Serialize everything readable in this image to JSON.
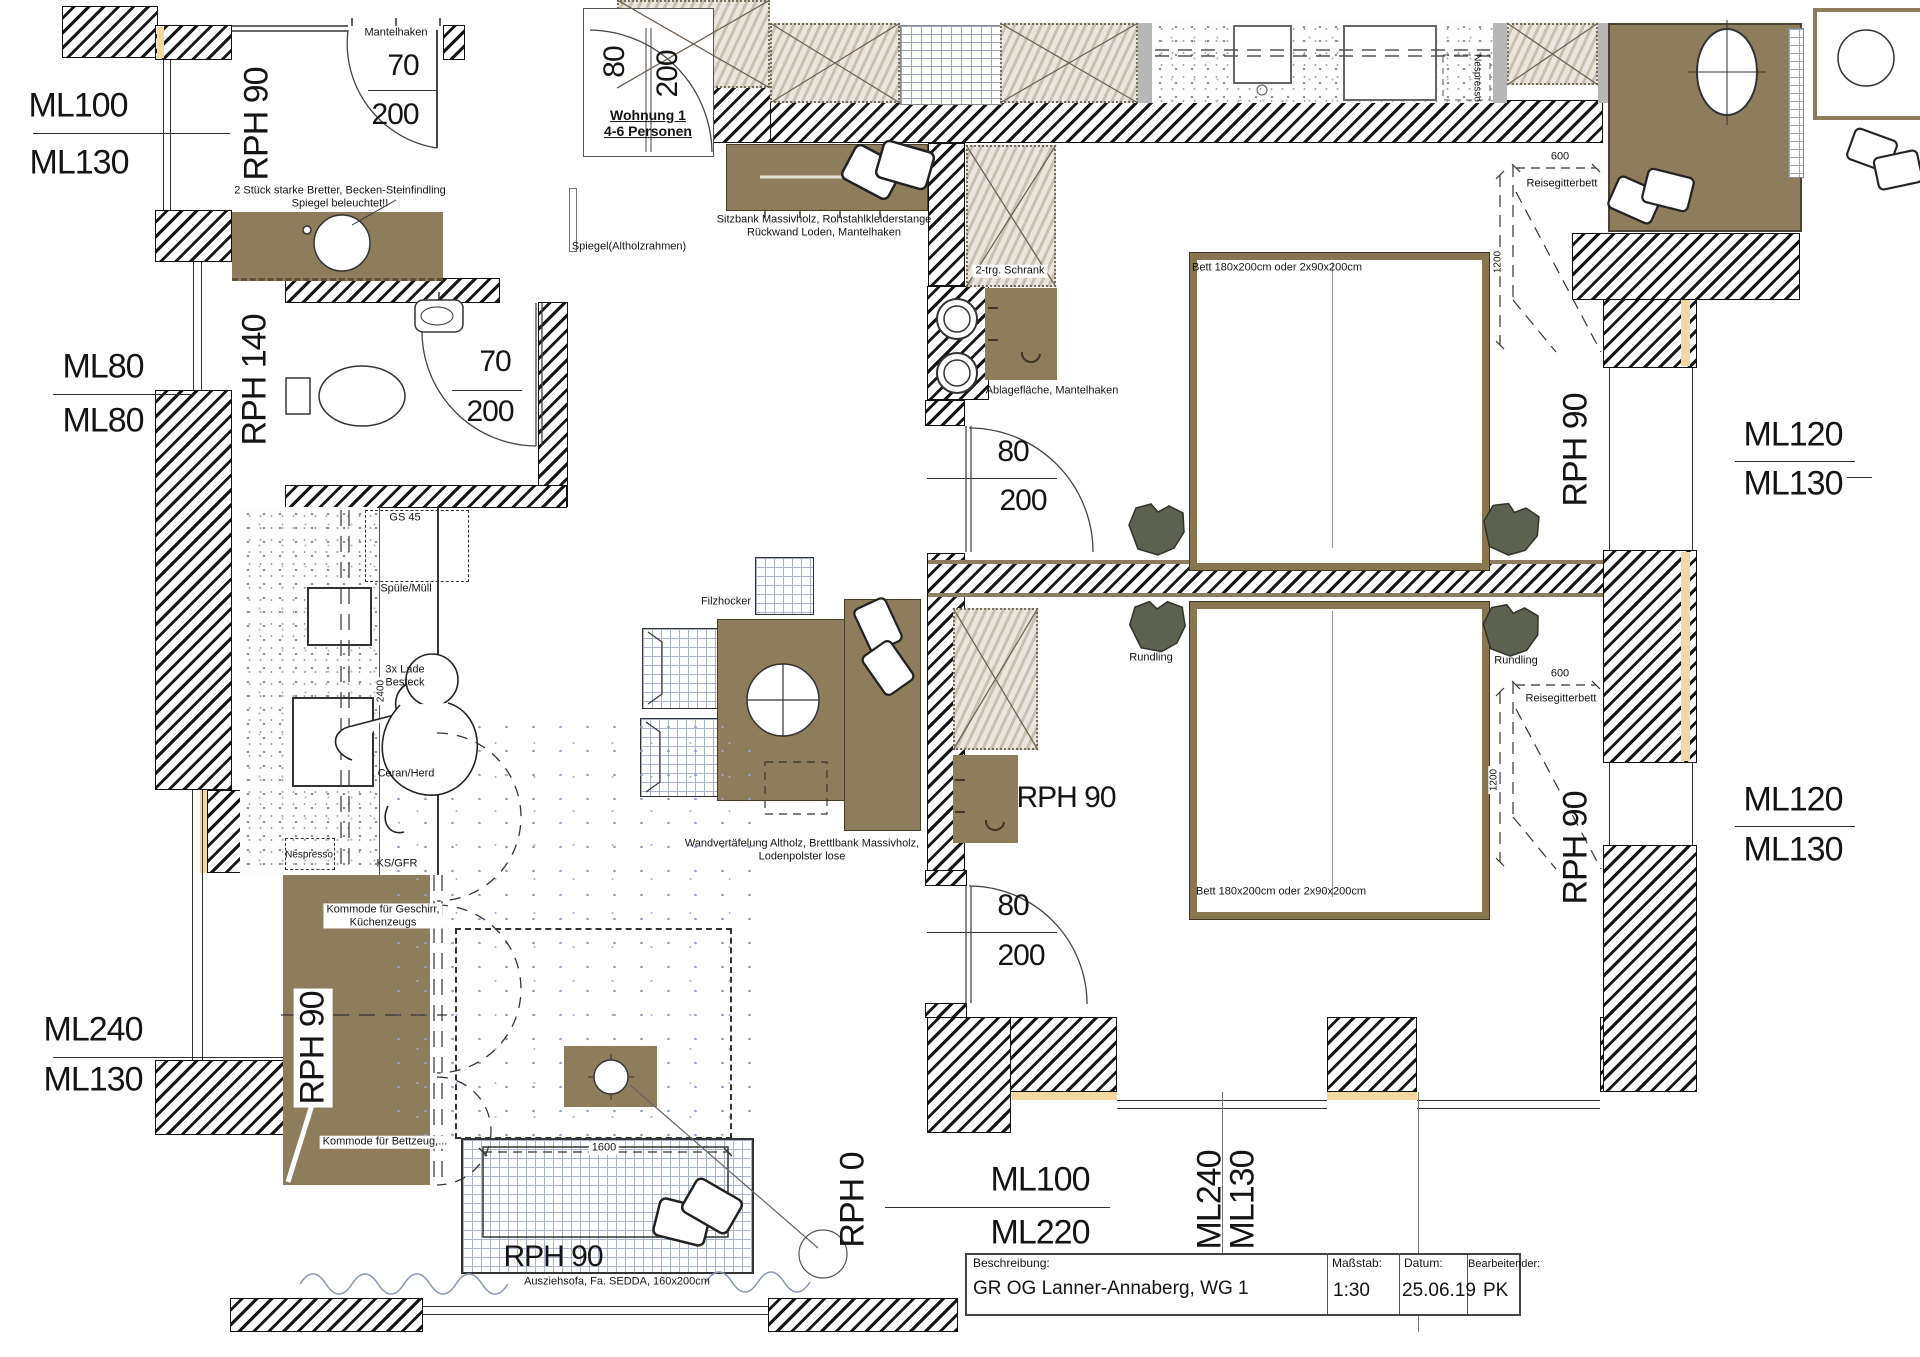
{
  "drawing": {
    "type": "floor-plan",
    "apartment": "Wohnung 1",
    "occupancy": "4-6 Personen"
  },
  "title_block": {
    "description_label": "Beschreibung:",
    "description": "GR OG Lanner-Annaberg, WG 1",
    "scale_label": "Maßstab:",
    "scale": "1:30",
    "date_label": "Datum:",
    "date": "25.06.19",
    "editor_label": "Bearbeitender:",
    "editor": "PK"
  },
  "palette": {
    "wood_brown": "#8e7d5d",
    "bed_frame": "#87764f",
    "wardrobe_beige": "#d9d2c5",
    "insulation_yellow": "#f3d99f",
    "stool_olive": "#5c6151",
    "grid_blue": "#a9b4cc",
    "curtain_blue": "#8a96bb",
    "line_dark": "#141414"
  },
  "label_groups": {
    "outer_dims": [
      {
        "id": "ml100-left",
        "t": "ML100",
        "x": 78,
        "y": 106,
        "fs": 34
      },
      {
        "id": "ml130-left",
        "t": "ML130",
        "x": 79,
        "y": 163,
        "fs": 34
      },
      {
        "id": "ml80-left-a",
        "t": "ML80",
        "x": 103,
        "y": 367,
        "fs": 34
      },
      {
        "id": "ml80-left-b",
        "t": "ML80",
        "x": 103,
        "y": 421,
        "fs": 34
      },
      {
        "id": "ml240-left",
        "t": "ML240",
        "x": 93,
        "y": 1030,
        "fs": 34
      },
      {
        "id": "ml130-left-b",
        "t": "ML130",
        "x": 93,
        "y": 1080,
        "fs": 34
      },
      {
        "id": "ml120-right-a",
        "t": "ML120",
        "x": 1793,
        "y": 435,
        "fs": 34
      },
      {
        "id": "ml130-right-a",
        "t": "ML130",
        "x": 1793,
        "y": 484,
        "fs": 34
      },
      {
        "id": "ml120-right-b",
        "t": "ML120",
        "x": 1793,
        "y": 800,
        "fs": 34
      },
      {
        "id": "ml130-right-b",
        "t": "ML130",
        "x": 1793,
        "y": 850,
        "fs": 34
      },
      {
        "id": "ml100-bottom",
        "t": "ML100",
        "x": 1040,
        "y": 1180,
        "fs": 34
      },
      {
        "id": "ml220-bottom",
        "t": "ML220",
        "x": 1040,
        "y": 1233,
        "fs": 34
      },
      {
        "id": "ml240-bottom",
        "t": "ML240",
        "x": 1210,
        "y": 1200,
        "fs": 34,
        "r": -90
      },
      {
        "id": "ml130-bottom",
        "t": "ML130",
        "x": 1243,
        "y": 1200,
        "fs": 34,
        "r": -90
      }
    ],
    "room_heights": [
      {
        "id": "rph90-corridor",
        "t": "RPH 90",
        "x": 257,
        "y": 124,
        "fs": 34,
        "r": -90
      },
      {
        "id": "rph140-bath",
        "t": "RPH 140",
        "x": 255,
        "y": 380,
        "fs": 34,
        "r": -90
      },
      {
        "id": "rph90-kommode",
        "t": "RPH 90",
        "x": 313,
        "y": 1048,
        "fs": 34,
        "r": -90,
        "bg": true
      },
      {
        "id": "rph90-sofa",
        "t": "RPH 90",
        "x": 553,
        "y": 1257,
        "fs": 30
      },
      {
        "id": "rph0-living",
        "t": "RPH 0",
        "x": 853,
        "y": 1200,
        "fs": 34,
        "r": -90
      },
      {
        "id": "rph90-bed1",
        "t": "RPH 90",
        "x": 1576,
        "y": 450,
        "fs": 34,
        "r": -90
      },
      {
        "id": "rph90-bed2",
        "t": "RPH 90",
        "x": 1576,
        "y": 848,
        "fs": 34,
        "r": -90
      },
      {
        "id": "rph90-bed2-big",
        "t": "RPH 90",
        "x": 1066,
        "y": 798,
        "fs": 30
      }
    ],
    "doors": [
      {
        "id": "door70-top-w",
        "t": "70",
        "x": 403,
        "y": 66,
        "fs": 30
      },
      {
        "id": "door70-top-h",
        "t": "200",
        "x": 395,
        "y": 115,
        "fs": 30
      },
      {
        "id": "door80-entry-w",
        "t": "80",
        "x": 615,
        "y": 62,
        "fs": 30,
        "r": -90
      },
      {
        "id": "door80-entry-h",
        "t": "200",
        "x": 668,
        "y": 74,
        "fs": 30,
        "r": -90
      },
      {
        "id": "wohnung-tag",
        "t": "Wohnung 1\n4-6 Personen",
        "x": 648,
        "y": 124,
        "fs": 14,
        "b": true,
        "u": true
      },
      {
        "id": "door70-bath-w",
        "t": "70",
        "x": 495,
        "y": 362,
        "fs": 30
      },
      {
        "id": "door70-bath-h",
        "t": "200",
        "x": 490,
        "y": 412,
        "fs": 30
      },
      {
        "id": "door80-bed1-w",
        "t": "80",
        "x": 1013,
        "y": 452,
        "fs": 30
      },
      {
        "id": "door80-bed1-h",
        "t": "200",
        "x": 1023,
        "y": 501,
        "fs": 30
      },
      {
        "id": "door80-bed2-w",
        "t": "80",
        "x": 1013,
        "y": 906,
        "fs": 30
      },
      {
        "id": "door80-bed2-h",
        "t": "200",
        "x": 1021,
        "y": 956,
        "fs": 30
      }
    ],
    "annotations": [
      {
        "id": "note-mantelhaken",
        "t": "Mantelhaken",
        "x": 396,
        "y": 33,
        "fs": 11
      },
      {
        "id": "note-bretter",
        "t": "2 Stück starke Bretter, Becken-Steinfindling\nSpiegel beleuchtet!!",
        "x": 340,
        "y": 197,
        "fs": 11
      },
      {
        "id": "note-spiegel",
        "t": "Spiegel(Altholzrahmen)",
        "x": 629,
        "y": 247,
        "fs": 11
      },
      {
        "id": "note-sitzbank",
        "t": "Sitzbank Massivholz, Rohstahlkleiderstange\nRückwand Loden, Mantelhaken",
        "x": 824,
        "y": 226,
        "fs": 11
      },
      {
        "id": "note-schrank1",
        "t": "2-trg. Schrank",
        "x": 1010,
        "y": 271,
        "fs": 11,
        "bg": true
      },
      {
        "id": "note-ablage1",
        "t": "Ablagefläche, Mantelhaken",
        "x": 1052,
        "y": 391,
        "fs": 11
      },
      {
        "id": "note-bett1",
        "t": "Bett 180x200cm oder 2x90x200cm",
        "x": 1277,
        "y": 268,
        "fs": 11
      },
      {
        "id": "note-bett2",
        "t": "Bett 180x200cm oder 2x90x200cm",
        "x": 1281,
        "y": 892,
        "fs": 11
      },
      {
        "id": "note-reisegitterbett1",
        "t": "Reisegitterbett",
        "x": 1562,
        "y": 184,
        "fs": 11
      },
      {
        "id": "note-reisegitterbett2",
        "t": "Reisegitterbett",
        "x": 1561,
        "y": 699,
        "fs": 11
      },
      {
        "id": "note-rundling1",
        "t": "Rundling",
        "x": 1151,
        "y": 658,
        "fs": 11
      },
      {
        "id": "note-rundling2",
        "t": "Rundling",
        "x": 1516,
        "y": 661,
        "fs": 11
      },
      {
        "id": "note-filzhocker",
        "t": "Filzhocker",
        "x": 726,
        "y": 602,
        "fs": 11
      },
      {
        "id": "note-wandvertaefelung",
        "t": "Wandvertäfelung Altholz, Brettlbank Massivholz,\nLodenpolster lose",
        "x": 802,
        "y": 850,
        "fs": 11
      },
      {
        "id": "note-gs45",
        "t": "GS 45",
        "x": 405,
        "y": 518,
        "fs": 11
      },
      {
        "id": "note-spuele",
        "t": "Spüle/Müll",
        "x": 406,
        "y": 589,
        "fs": 11
      },
      {
        "id": "note-lade",
        "t": "3x Lade\nBesteck",
        "x": 405,
        "y": 676,
        "fs": 11
      },
      {
        "id": "note-ceran",
        "t": "Ceran/Herd",
        "x": 406,
        "y": 774,
        "fs": 11
      },
      {
        "id": "note-nespresso",
        "t": "Nespresso",
        "x": 309,
        "y": 855,
        "fs": 10
      },
      {
        "id": "note-ksgfr",
        "t": "KS/GFR",
        "x": 397,
        "y": 864,
        "fs": 11
      },
      {
        "id": "note-kommode1",
        "t": "Kommode für Geschirr,\nKüchenzeugs",
        "x": 383,
        "y": 916,
        "fs": 11,
        "bg": true
      },
      {
        "id": "note-kommode2",
        "t": "Kommode für Bettzeug,...",
        "x": 385,
        "y": 1142,
        "fs": 11,
        "bg": true
      },
      {
        "id": "note-ausziehsofa",
        "t": "Ausziehsofa, Fa. SEDDA, 160x200cm",
        "x": 617,
        "y": 1282,
        "fs": 11
      },
      {
        "id": "note-nespresso-neighbor",
        "t": "Nespresso",
        "x": 1477,
        "y": 78,
        "fs": 10,
        "r": 90
      }
    ],
    "dims": [
      {
        "id": "dim-600-1",
        "t": "600",
        "x": 1560,
        "y": 157,
        "fs": 11,
        "bg": true
      },
      {
        "id": "dim-1200-1",
        "t": "1200",
        "x": 1498,
        "y": 262,
        "fs": 10,
        "r": -90,
        "bg": true
      },
      {
        "id": "dim-600-2",
        "t": "600",
        "x": 1560,
        "y": 674,
        "fs": 11,
        "bg": true
      },
      {
        "id": "dim-1200-2",
        "t": "1200",
        "x": 1494,
        "y": 780,
        "fs": 10,
        "r": -90,
        "bg": true
      },
      {
        "id": "dim-1600",
        "t": "1600",
        "x": 604,
        "y": 1148,
        "fs": 11,
        "bg": true
      },
      {
        "id": "dim-2400",
        "t": "2400",
        "x": 381,
        "y": 691,
        "fs": 10,
        "r": -90,
        "bg": true
      }
    ],
    "title_block": [
      {
        "id": "tb-description-label",
        "ref": "title_block.description_label",
        "x": 973,
        "y": 1257,
        "fs": 12,
        "o": "lt"
      },
      {
        "id": "tb-description-value",
        "ref": "title_block.description",
        "x": 973,
        "y": 1278,
        "fs": 19,
        "o": "lt"
      },
      {
        "id": "tb-scale-label",
        "ref": "title_block.scale_label",
        "x": 1332,
        "y": 1257,
        "fs": 12,
        "o": "lt"
      },
      {
        "id": "tb-scale-value",
        "ref": "title_block.scale",
        "x": 1333,
        "y": 1280,
        "fs": 19,
        "o": "lt"
      },
      {
        "id": "tb-date-label",
        "ref": "title_block.date_label",
        "x": 1404,
        "y": 1257,
        "fs": 12,
        "o": "lt"
      },
      {
        "id": "tb-date-value",
        "ref": "title_block.date",
        "x": 1402,
        "y": 1280,
        "fs": 19,
        "o": "lt"
      },
      {
        "id": "tb-editor-label",
        "ref": "title_block.editor_label",
        "x": 1468,
        "y": 1258,
        "fs": 11,
        "o": "lt"
      },
      {
        "id": "tb-editor-value",
        "ref": "title_block.editor",
        "x": 1483,
        "y": 1280,
        "fs": 19,
        "o": "lt"
      }
    ]
  }
}
